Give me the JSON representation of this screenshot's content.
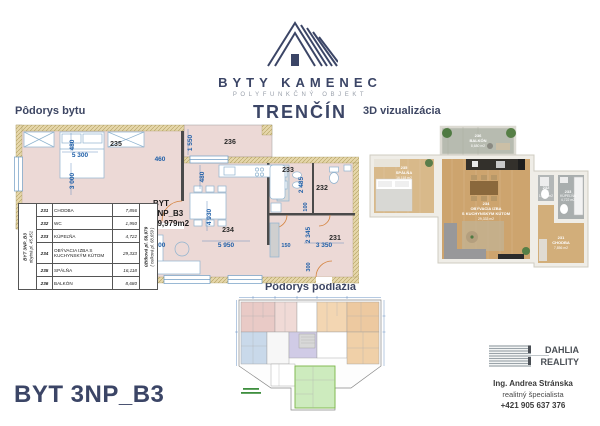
{
  "brand": {
    "name": "BYTY KAMENEC",
    "subtitle": "POLYFUNKČNÝ OBJEKT",
    "city": "TRENČÍN"
  },
  "headings": {
    "apartment_plan": "Pôdorys bytu",
    "visualization": "3D vizualizácia",
    "floor_plan": "Pôdorys podlažia"
  },
  "title": "BYT 3NP_B3",
  "plan": {
    "unit_label": {
      "l1": "BYT",
      "l2": "2NP_B3",
      "l3": "59,979m2"
    },
    "rooms": {
      "r231": "231",
      "r232": "232",
      "r233": "233",
      "r234": "234",
      "r235": "235",
      "r236": "236"
    },
    "dims": {
      "d480a": "480",
      "d5300": "5 300",
      "d3000": "3 000",
      "d460": "460",
      "d1550": "1 550",
      "d480b": "480",
      "d2485": "2 485",
      "d100": "100",
      "d4930": "4 930",
      "d5950": "5 950",
      "d300a": "300",
      "d150": "150",
      "d2345": "2 345",
      "d3350": "3 350",
      "d300b": "300"
    }
  },
  "legend": {
    "side_left_top": "BYT 3NP_B3",
    "side_left_bottom": "obytná pl. 45,451",
    "side_right_top": "úžitková pl. 59,979",
    "side_right_bottom": "( celková pl. 68,659 )",
    "rows": [
      {
        "num": "231",
        "name": "CHODBA",
        "area": "7,856"
      },
      {
        "num": "232",
        "name": "WC",
        "area": "1,950"
      },
      {
        "num": "233",
        "name": "KÚPEĽŇA",
        "area": "4,722"
      },
      {
        "num": "234",
        "name": "OBÝVACIA IZBA S KUCHYNSKÝM KÚTOM",
        "area": "29,333"
      },
      {
        "num": "235",
        "name": "SPÁLŇA",
        "area": "16,118"
      },
      {
        "num": "236",
        "name": "BALKÓN",
        "area": "8,680"
      }
    ]
  },
  "viz": {
    "balkon": {
      "num": "236",
      "name": "BALKÓN",
      "area": "8,680 m2"
    },
    "spalna": {
      "num": "235",
      "name": "SPÁLŇA",
      "area": "16,118 m2"
    },
    "obyvacka": {
      "num": "234",
      "name1": "OBÝVACIA IZBA",
      "name2": "S KUCHYNSKÝM KÚTOM",
      "area": "29,333 m2"
    },
    "wc": {
      "num": "232",
      "name": "WC",
      "area": "1,950 m2"
    },
    "kupelna": {
      "num": "233",
      "name": "KÚPEĽŇA",
      "area": "4,722 m2"
    },
    "chodba": {
      "num": "231",
      "name": "CHODBA",
      "area": "7,856 m2"
    }
  },
  "agent": {
    "company1": "DAHLIA",
    "company2": "REALITY",
    "name": "Ing. Andrea Stránska",
    "role": "realitný špecialista",
    "phone": "+421 905 637 376"
  },
  "colors": {
    "navy": "#3b4566",
    "dim_blue": "#1f5fa8",
    "room_pink": "#ecd9d6",
    "wall_tan": "#e6d7ab",
    "highlight_green": "#cdebbe"
  }
}
